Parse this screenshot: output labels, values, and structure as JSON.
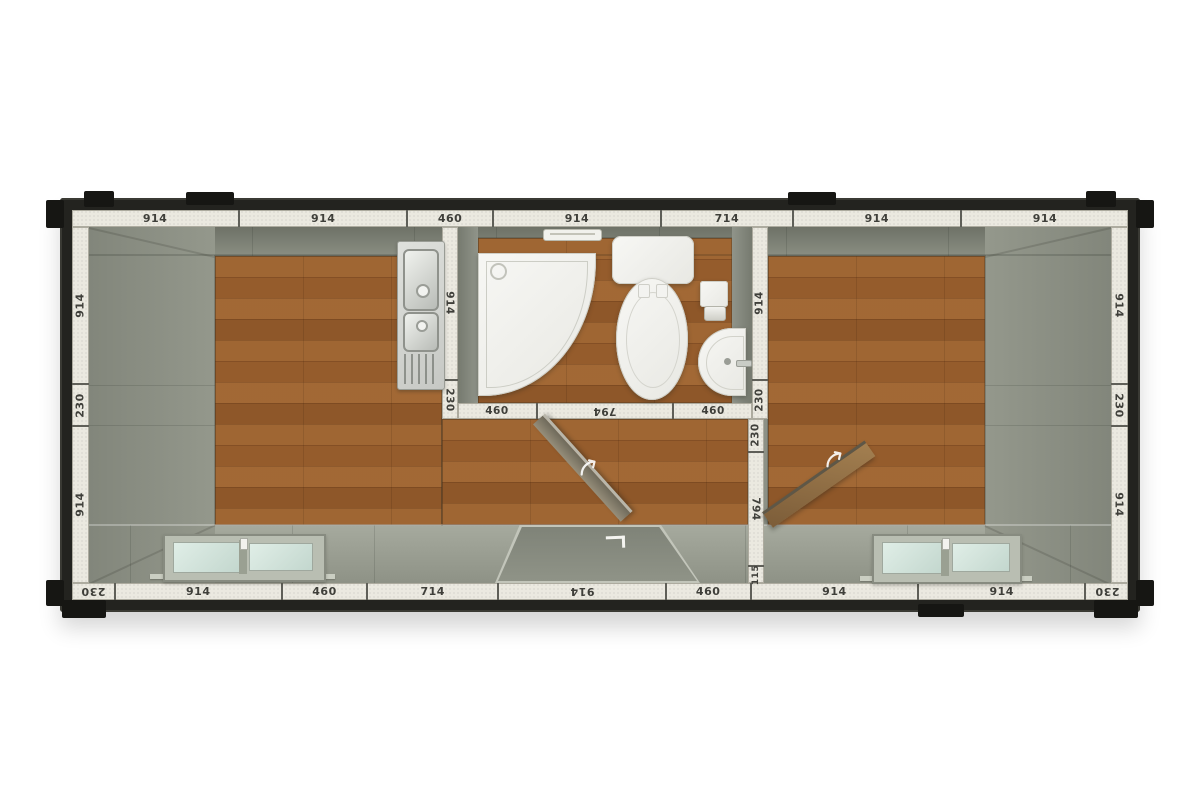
{
  "plan": {
    "title": "container-cabin-floor-plan-top-view",
    "rooms": [
      "living-room-left",
      "bathroom-center",
      "room-right"
    ]
  },
  "dims": {
    "top": [
      "914",
      "914",
      "460",
      "914",
      "714",
      "914",
      "914"
    ],
    "bottom": [
      "230",
      "914",
      "460",
      "714",
      "914",
      "460",
      "914",
      "914",
      "230"
    ],
    "left": [
      "914",
      "230",
      "914"
    ],
    "right": [
      "914",
      "230",
      "914"
    ],
    "bath_west": [
      "914",
      "230"
    ],
    "bath_east": [
      "914",
      "230"
    ],
    "bath_south": [
      "460",
      "794",
      "460"
    ],
    "partition": [
      "230",
      "794",
      "115"
    ]
  },
  "fixtures": {
    "kitchen_sink": "double-bowl-sink-with-drainer",
    "shower": "quadrant-shower-tray",
    "toilet": "toilet-with-cistern",
    "toilet_paper_holder": "toilet-paper-holder",
    "basin": "corner-washbasin",
    "window_left": "sliding-window",
    "window_right": "sliding-window",
    "entrance": "entrance-door-opening",
    "door_bathroom": "bathroom-door-leaf",
    "door_room": "room-door-leaf",
    "vent": "bathroom-wall-vent"
  },
  "icons": {
    "door_swing": "door-swing-arrow",
    "corner_mark": "door-corner-mark"
  },
  "colors": {
    "frame": "#23231f",
    "dimension_strip": "#ebe9e0",
    "wall_gray": "#8d9186",
    "wood_floor": "#c49b6c",
    "window_glass": "#d4e4dd",
    "fixture_white": "#f4f4f1",
    "label_text": "#3f3f3a"
  }
}
